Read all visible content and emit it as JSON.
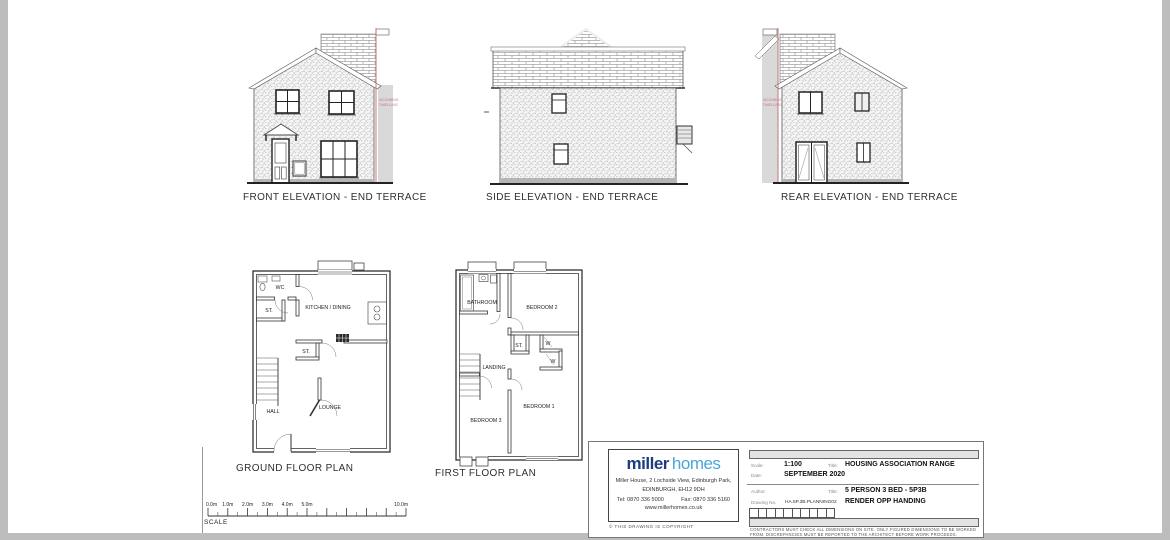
{
  "elevations": {
    "front": {
      "label": "FRONT ELEVATION - END TERRACE",
      "adjoining_line1": "ADJOINING",
      "adjoining_line2": "DWELLING"
    },
    "side": {
      "label": "SIDE ELEVATION - END TERRACE"
    },
    "rear": {
      "label": "REAR ELEVATION - END TERRACE",
      "adjoining_line1": "ADJOINING",
      "adjoining_line2": "DWELLING"
    }
  },
  "floor_plans": {
    "ground": {
      "label": "GROUND FLOOR PLAN",
      "rooms": {
        "wc": "WC",
        "store1": "ST.",
        "kitchen": "KITCHEN / DINING",
        "store2": "ST.",
        "hall": "HALL",
        "lounge": "LOUNGE"
      }
    },
    "first": {
      "label": "FIRST FLOOR PLAN",
      "rooms": {
        "bathroom": "BATHROOM",
        "bedroom2": "BEDROOM 2",
        "store": "ST.",
        "wardrobe1": "W",
        "wardrobe2": "W",
        "landing": "LANDING",
        "bedroom3": "BEDROOM 3",
        "bedroom1": "BEDROOM 1"
      }
    }
  },
  "scale_bar": {
    "label": "SCALE",
    "ticks": [
      "0.0m",
      "1.0m",
      "2.0m",
      "3.0m",
      "4.0m",
      "5.0m",
      "10.0m"
    ]
  },
  "title_block": {
    "logo_part1": "miller",
    "logo_part2": "homes",
    "address_line1": "Miller House, 2 Lochside View, Edinburgh Park,",
    "address_line2": "EDINBURGH, EH12 9DH",
    "tel": "Tel: 0870 336 5000",
    "fax": "Fax: 0870 336 5160",
    "website": "www.millerhomes.co.uk",
    "copyright": "© THIS DRAWING IS COPYRIGHT",
    "scale_label": "Scale:",
    "scale_value": "1:100",
    "date_label": "Date:",
    "date_value": "SEPTEMBER 2020",
    "title1_label": "Title:",
    "title1_value": "HOUSING ASSOCIATION RANGE",
    "author_label": "Author:",
    "title2_label": "Title:",
    "title2_value": "5 PERSON 3 BED - 5P3B",
    "drawing_no_label": "Drawing No.",
    "drawing_no_value": "HA.5P.3B.PLANNING02",
    "handing_note": "RENDER OPP HANDING",
    "disclaimer_line1": "CONTRACTORS MUST CHECK ALL DIMENSIONS ON SITE. ONLY FIGURED DIMENSIONS TO BE WORKED",
    "disclaimer_line2": "FROM. DISCREPANCIES MUST BE REPORTED TO THE ARCHITECT BEFORE WORK PROCEEDS."
  },
  "colors": {
    "boundary_red": "#c66a6a",
    "adjoining_text": "#cc7788",
    "logo_navy": "#1d3e7e",
    "logo_blue": "#4aa6d6",
    "edge_grey": "#bdbdbd",
    "adjoining_grey": "#d9d9d9"
  }
}
